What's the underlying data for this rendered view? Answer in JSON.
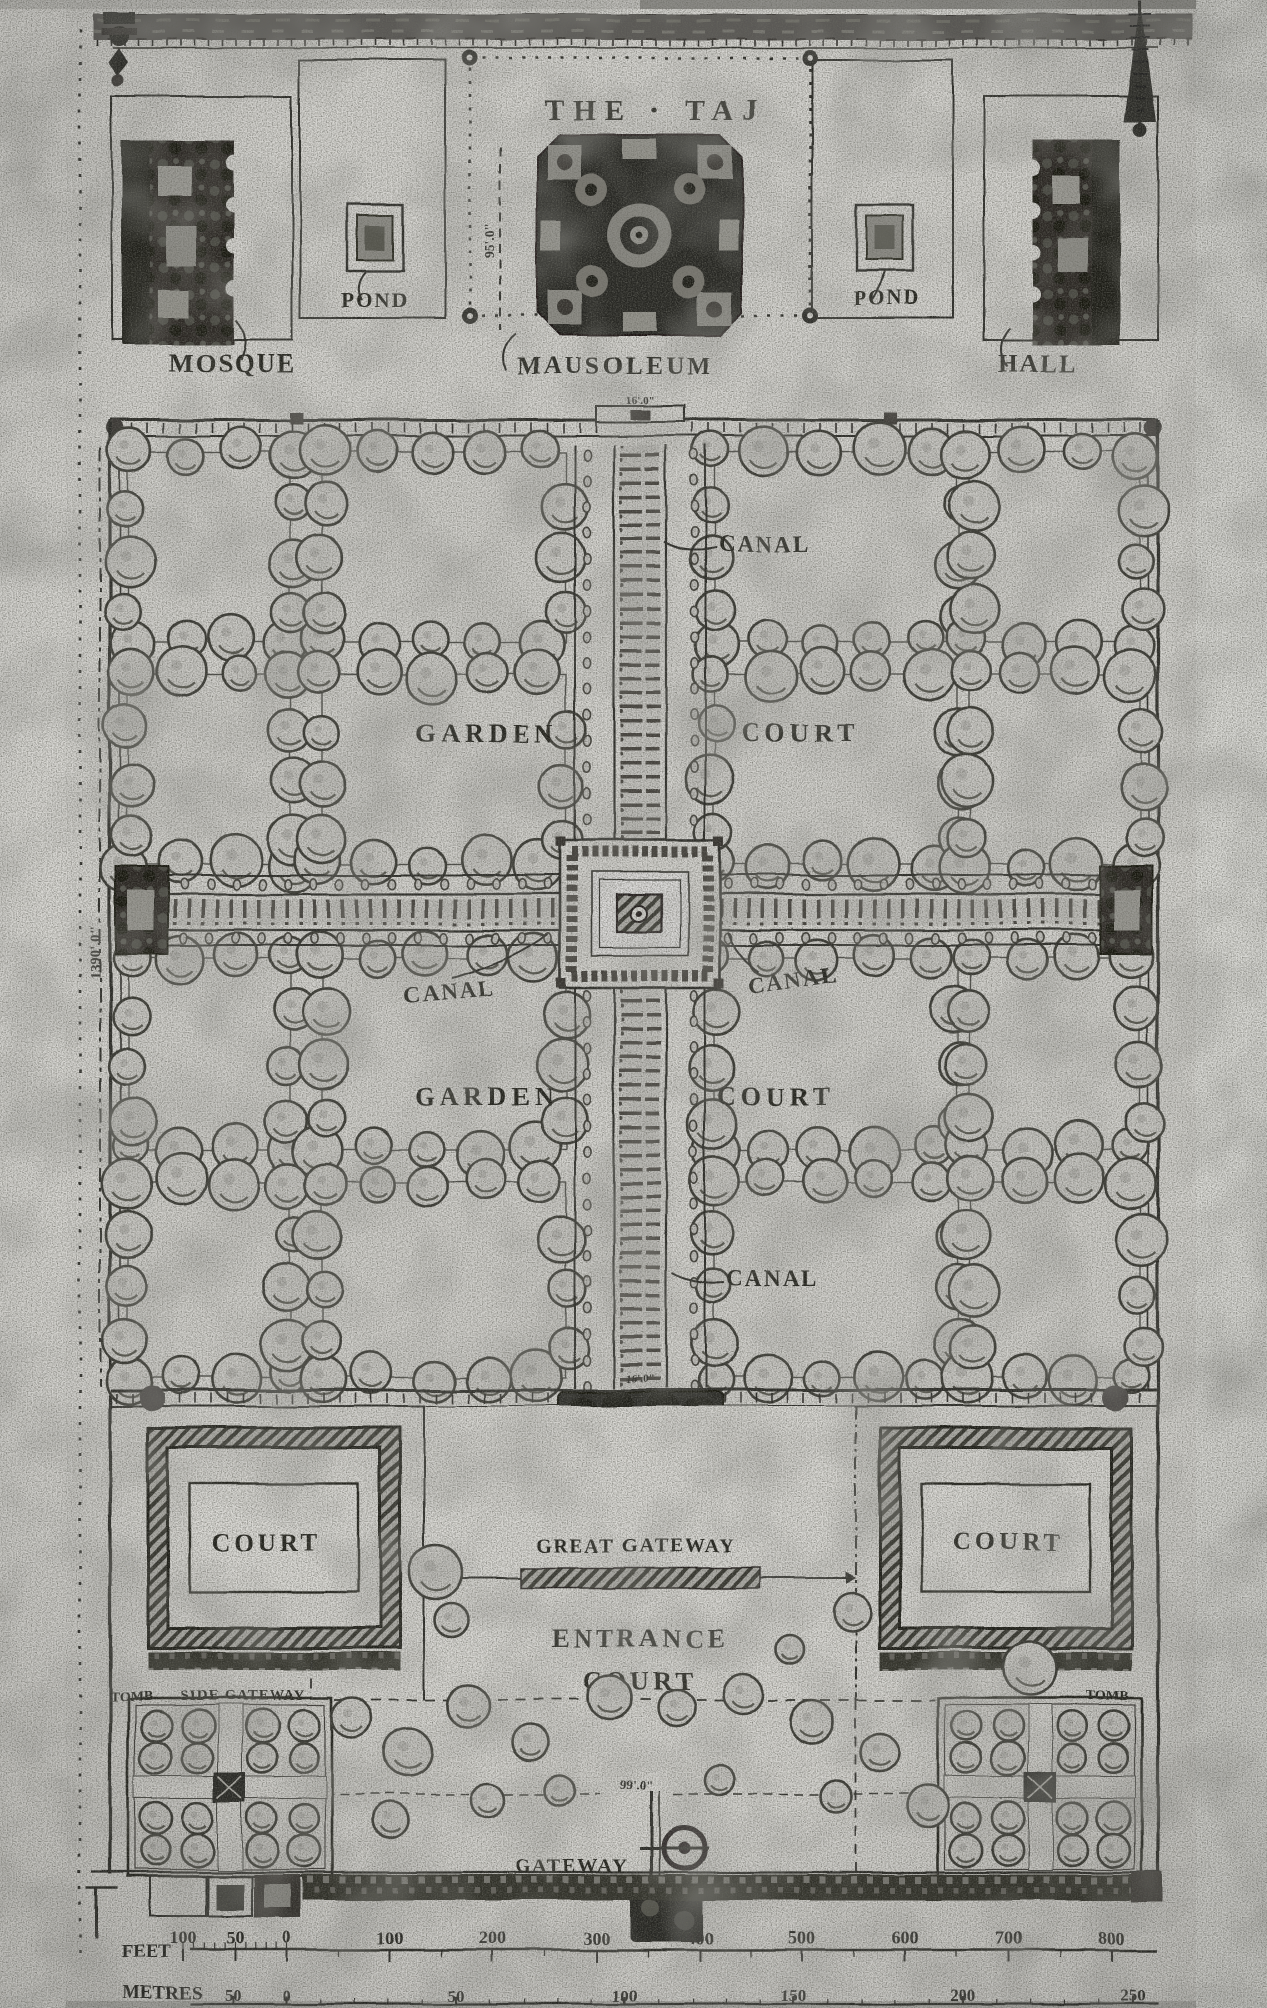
{
  "plan": {
    "title": "THE · TAJ",
    "buildings": {
      "mosque": "MOSQUE",
      "mausoleum": "MAUSOLEUM",
      "hall": "HALL",
      "pond_left": "POND",
      "pond_right": "POND",
      "great_gateway": "GREAT GATEWAY",
      "gateway": "GATEWAY",
      "tomb_left": "TOMB",
      "tomb_right": "TOMB"
    },
    "grounds": {
      "canal_upper": "CANAL",
      "canal_left": "CANAL",
      "canal_right": "CANAL",
      "canal_lower": "CANAL",
      "garden_upper": "GARDEN",
      "garden_lower": "GARDEN",
      "court_upper": "COURT",
      "court_lower": "COURT",
      "court_left": "COURT",
      "court_right": "COURT",
      "entrance_line1": "ENTRANCE",
      "entrance_line2": "COURT",
      "side_gateway": "SIDE GATEWAY"
    },
    "dimensions": {
      "terrace_offset": "95'.0\"",
      "water_gate_north": "16'.0\"",
      "garden_side": "1390'.0\"",
      "water_gate_south": "16'.0\"",
      "forecourt_depth": "99'.0\""
    },
    "scale_bar": {
      "feet_label": "FEET",
      "feet_ticks": [
        "100",
        "50",
        "0",
        "100",
        "200",
        "300",
        "400",
        "500",
        "600",
        "700",
        "800"
      ],
      "metres_label": "METRES",
      "metres_ticks": [
        "50",
        "0",
        "50",
        "100",
        "150",
        "200",
        "250"
      ]
    }
  }
}
